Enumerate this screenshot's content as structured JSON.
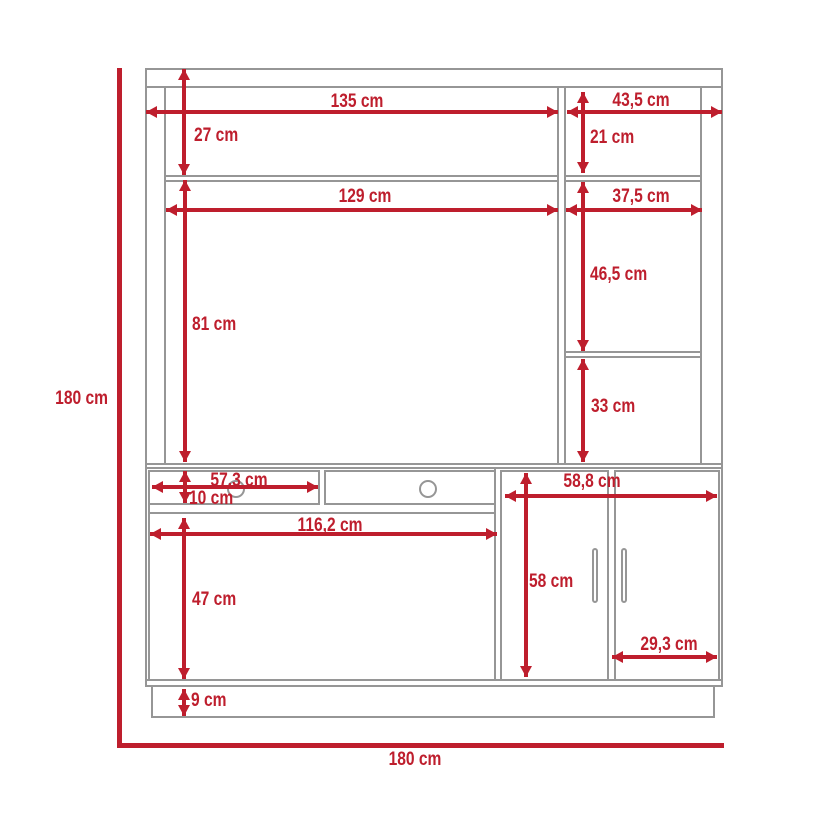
{
  "colors": {
    "dimension_red": "#be1e2d",
    "outline_gray": "#969696"
  },
  "unit": "cm",
  "overall": {
    "height_label": "180 cm",
    "width_label": "180 cm"
  },
  "dims": {
    "top_left_width": "135 cm",
    "top_right_width": "43,5 cm",
    "top_left_height": "27 cm",
    "top_right_height": "21 cm",
    "tv_opening_width": "129 cm",
    "right_shelf_width": "37,5 cm",
    "tv_opening_height": "81 cm",
    "right_upper_shelf_height": "46,5 cm",
    "right_lower_shelf_height": "33 cm",
    "drawer_width": "57,3 cm",
    "drawer_height": "10 cm",
    "doors_cabinet_width": "58,8 cm",
    "lower_opening_width": "116,2 cm",
    "lower_opening_height": "47 cm",
    "doors_cabinet_height": "58 cm",
    "door_width": "29,3 cm",
    "base_height": "9 cm"
  }
}
